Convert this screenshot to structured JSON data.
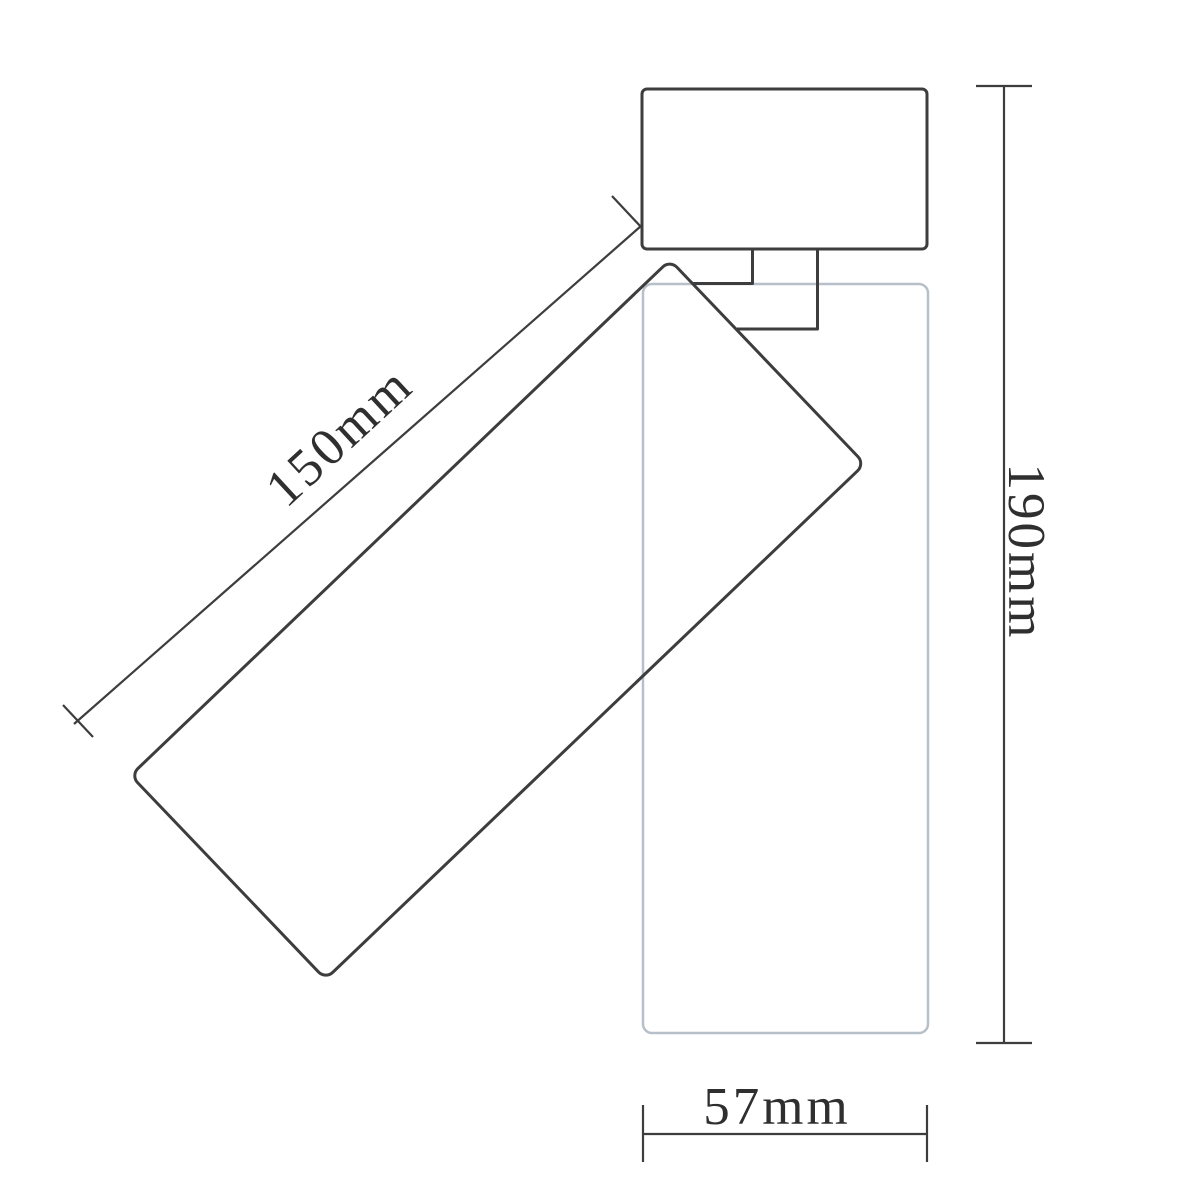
{
  "drawing": {
    "type": "technical-dimension-drawing",
    "subject": "adjustable ceiling spotlight side view with mount box, tilted lamp body and ghost vertical position",
    "labels": {
      "tilted_length": "150mm",
      "total_height": "190mm",
      "body_width": "57mm"
    },
    "colors": {
      "line": "#3d3d3d",
      "ghost": "#b7bfc9",
      "text": "#2f2f2f",
      "background": "#ffffff"
    }
  }
}
